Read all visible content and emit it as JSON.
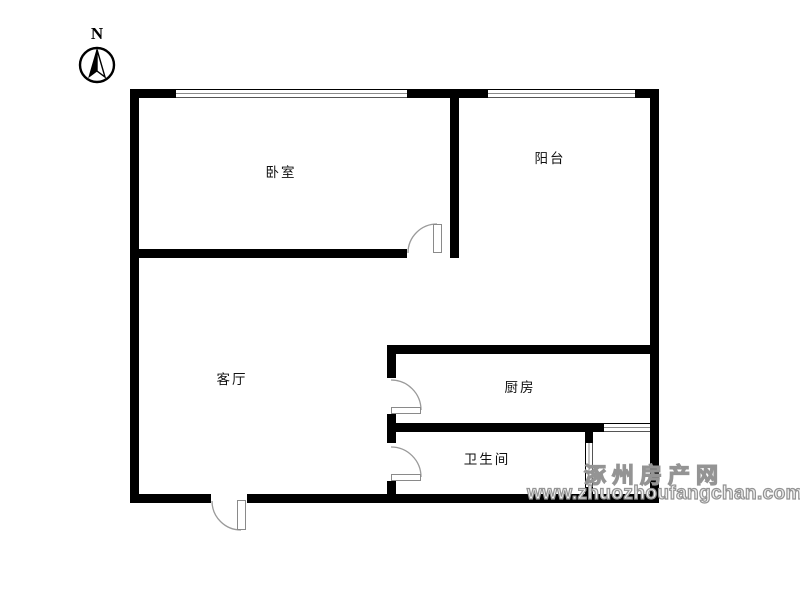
{
  "compass": {
    "label": "N"
  },
  "rooms": [
    {
      "id": "bedroom",
      "label": "卧室"
    },
    {
      "id": "balcony",
      "label": "阳台"
    },
    {
      "id": "living-room",
      "label": "客厅"
    },
    {
      "id": "kitchen",
      "label": "厨房"
    },
    {
      "id": "bathroom",
      "label": "卫生间"
    }
  ],
  "watermark": {
    "site_name": "涿州房产网",
    "site_url": "www.zhuozhoufangchan.com"
  },
  "colors": {
    "wall": "#000000",
    "door_arc": "#9a9a9a",
    "watermark_gray": "#949494",
    "background": "#ffffff"
  }
}
